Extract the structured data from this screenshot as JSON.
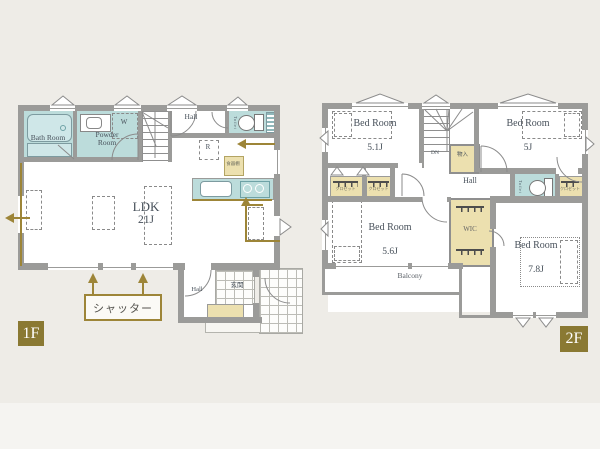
{
  "floor1": {
    "tag": "1F",
    "bath": "Bath Room",
    "powder": "Powder Room",
    "hall_upper": "Hall",
    "toilet": "Toilet",
    "washer": "W",
    "fridge": "R",
    "cupboard": "食器棚",
    "ldk_name": "LDK",
    "ldk_size": "21J",
    "hall_entry": "Hall",
    "entrance": "玄関",
    "shutter_note": "シャッター"
  },
  "floor2": {
    "tag": "2F",
    "beds": {
      "b1": {
        "name": "Bed Room",
        "size": "5.1J"
      },
      "b2": {
        "name": "Bed Room",
        "size": "5J"
      },
      "b3": {
        "name": "Bed Room",
        "size": "5.6J"
      },
      "b4": {
        "name": "Bed Room",
        "size": "7.8J"
      }
    },
    "stairs_down": "DN",
    "storage": "物入",
    "hall": "Hall",
    "toilet": "Toilet",
    "closet": "クロゼット",
    "wic": "WIC",
    "balcony": "Balcony"
  },
  "colors": {
    "accent_gold": "#9d8538",
    "floor_tag_bg": "#8a7933",
    "wet_area_teal": "#bcdcdb",
    "storage_beige": "#ece0af",
    "wall_gray": "#9b9b99",
    "background": "#eeece7"
  }
}
